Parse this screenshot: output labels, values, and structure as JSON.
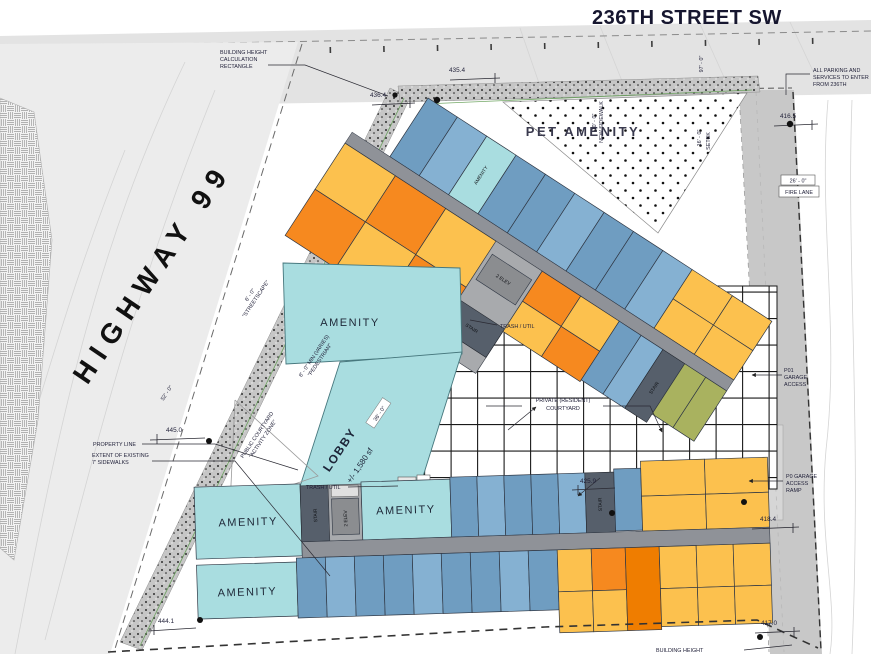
{
  "titles": {
    "street": "236TH STREET SW",
    "highway": "HIGHWAY 99"
  },
  "areas": {
    "pet_amenity": "PET AMENITY",
    "amenity": "AMENITY",
    "lobby": "LOBBY",
    "lobby_sf": "+/- 1,580 sf",
    "stair": "STAIR",
    "elev": "2 ELEV",
    "trash_util": "TRASH / UTIL",
    "private_courtyard_1": "PRIVATE (RESIDENT)",
    "private_courtyard_2": "COURTYARD",
    "public_courtyard_1": "PUBLIC COURTYARD",
    "public_courtyard_2": "\"ACTIVITY ZONE\""
  },
  "notes": {
    "bh1": "BUILDING HEIGHT",
    "bh2": "CALCULATION",
    "bh3": "RECTANGLE",
    "parking1": "ALL PARKING AND",
    "parking2": "SERVICES TO ENTER",
    "parking3": "FROM 236TH",
    "property_line": "PROPERTY LINE",
    "sidewalks1": "EXTENT OF EXISTING",
    "sidewalks2": "7' SIDEWALKS",
    "p01_1": "P01",
    "p01_2": "GARAGE",
    "p01_3": "ACCESS",
    "ramp1": "P0 GARAGE",
    "ramp2": "ACCESS",
    "ramp3": "RAMP",
    "fire_lane": "FIRE LANE",
    "streetscape_1": "6' - 0\"",
    "streetscape_2": "\"STREETSCAPE\"",
    "pedestrian_1": "8' - 0\" MIN (VARIES)",
    "pedestrian_2": "\"PEDESTRIAN\"",
    "new_sidewalk_1": "10' - 0\"",
    "new_sidewalk_2": "NEW SIDEWALK",
    "setback_1": "16' - 0\"",
    "setback_2": "SETBK",
    "bh_bottom": "BUILDING HEIGHT"
  },
  "dimensions": {
    "d52": "52' - 0\"",
    "d97": "97' - 0\"",
    "d36": "36' - 0\"",
    "d26": "26' - 0\""
  },
  "elevations": {
    "e1": "435.4",
    "e2": "436.4",
    "e3": "416.5",
    "e4": "445.0",
    "e5": "444.1",
    "e6": "425.9",
    "e7": "418.4",
    "e8": "417.0"
  },
  "colors": {
    "unit_blue": "#6f9dc1",
    "unit_blue_light": "#85b1d2",
    "unit_teal": "#a9dde0",
    "unit_yellow": "#fcc14e",
    "unit_orange": "#f6891f",
    "unit_orange_deep": "#ef7d00",
    "unit_olive": "#a9b25f",
    "corridor_gray": "#8f9298",
    "core_gray": "#a8aaad",
    "stair_dark": "#565f6b",
    "road_gray": "#c8c8c8",
    "street_gray": "#e3e3e3",
    "highway_gray": "#ececec",
    "grid_line": "#1a1a1a"
  }
}
